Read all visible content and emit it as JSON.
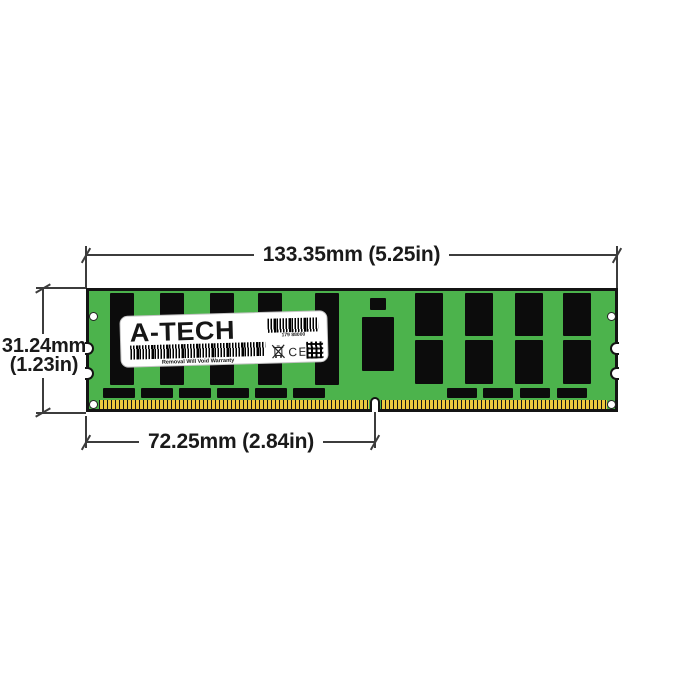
{
  "dimensions": {
    "width_label": "133.35mm (5.25in)",
    "height_label_line1": "31.24mm",
    "height_label_line2": "(1.23in)",
    "pin_label": "72.25mm (2.84in)"
  },
  "label": {
    "brand": "A-TECH",
    "sku": "179 88000",
    "warranty": "Removal Will Void Warranty",
    "ce_mark": "CE"
  },
  "colors": {
    "pcb_green": "#4cb34c",
    "chip_black": "#0c0c0c",
    "pin_gold": "#ecc93f",
    "outline": "#141414",
    "dim_line": "#3c3c3c"
  }
}
